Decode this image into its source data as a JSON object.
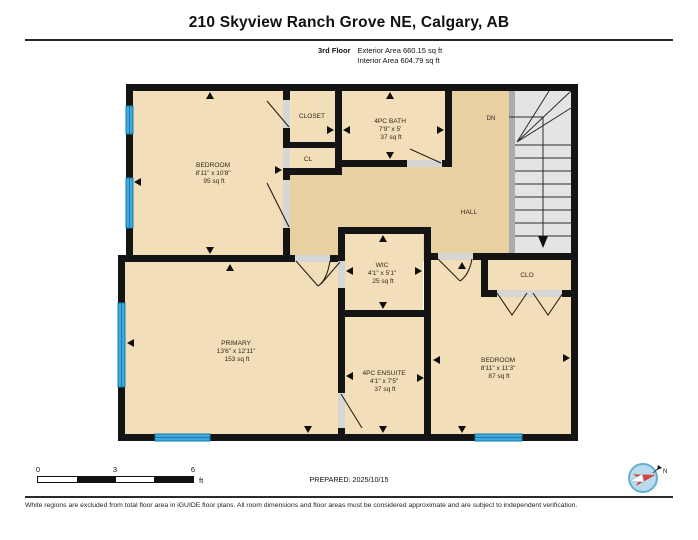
{
  "header": {
    "title": "210 Skyview Ranch Grove NE, Calgary, AB",
    "floor_label": "3rd Floor",
    "exterior_area": "Exterior Area 660.15 sq ft",
    "interior_area": "Interior Area 604.79 sq ft"
  },
  "plan": {
    "rooms": {
      "bedroom1": {
        "name": "BEDROOM",
        "dims": "8'11\" x 10'8\"",
        "area": "95 sq ft"
      },
      "closet": {
        "name": "CLOSET"
      },
      "cl": {
        "name": "CL"
      },
      "bath": {
        "name": "4PC BATH",
        "dims": "7'9\" x 5'",
        "area": "37 sq ft"
      },
      "stairs": {
        "label": "DN"
      },
      "hall": {
        "name": "HALL"
      },
      "wic": {
        "name": "WIC",
        "dims": "4'1\" x 5'1\"",
        "area": "25 sq ft"
      },
      "clo": {
        "name": "CLO"
      },
      "primary": {
        "name": "PRIMARY",
        "dims": "13'6\" x 12'11\"",
        "area": "153 sq ft"
      },
      "ensuite": {
        "name": "4PC ENSUITE",
        "dims": "4'1\" x 7'5\"",
        "area": "37 sq ft"
      },
      "bedroom2": {
        "name": "BEDROOM",
        "dims": "8'11\" x 11'3\"",
        "area": "87 sq ft"
      }
    },
    "colors": {
      "room_fill": "#f2dfba",
      "hall_fill": "#e9d0a2",
      "wall": "#141414",
      "window": "#3fa9dc",
      "stairs": "#e4e4e4",
      "door_opening": "#d6d6d6"
    }
  },
  "scale_bar": {
    "tick0": "0",
    "tick1": "3",
    "tick2": "6",
    "unit": "ft"
  },
  "footer": {
    "prepared": "PREPARED: 2025/10/15",
    "compass_label": "N",
    "disclaimer": "White regions are excluded from total floor area in iGUIDE floor plans. All room dimensions and floor areas must be considered approximate and are subject to independent verification."
  }
}
